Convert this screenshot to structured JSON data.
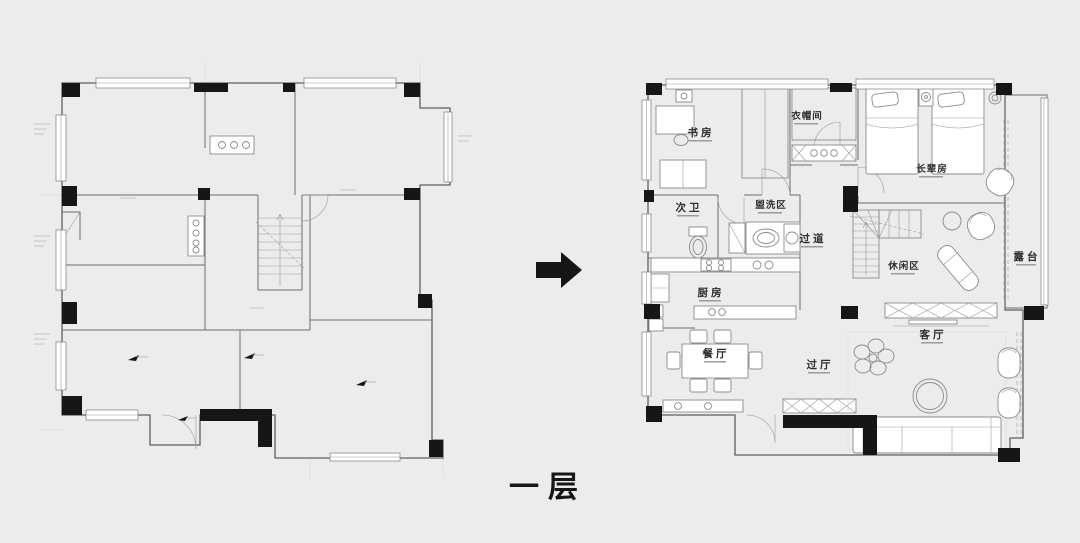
{
  "page": {
    "background": "#ececec",
    "caption": "一层"
  },
  "colors": {
    "ink": "#161616",
    "wall_line": "#5f5f5f",
    "furniture_line": "#8a8a8a",
    "floor": "#ffffff"
  },
  "icons": {
    "transform_arrow": "right-arrow"
  },
  "right_plan": {
    "rooms": [
      {
        "id": "study",
        "label": "书房"
      },
      {
        "id": "cloakroom",
        "label": "衣帽间"
      },
      {
        "id": "elder-bedroom",
        "label": "长辈房"
      },
      {
        "id": "second-bath",
        "label": "次卫"
      },
      {
        "id": "wash-area",
        "label": "盥洗区"
      },
      {
        "id": "corridor",
        "label": "过道"
      },
      {
        "id": "leisure-area",
        "label": "休闲区"
      },
      {
        "id": "terrace",
        "label": "露台"
      },
      {
        "id": "kitchen",
        "label": "厨房"
      },
      {
        "id": "dining-room",
        "label": "餐厅"
      },
      {
        "id": "hallway",
        "label": "过厅"
      },
      {
        "id": "living-room",
        "label": "客厅"
      }
    ]
  }
}
